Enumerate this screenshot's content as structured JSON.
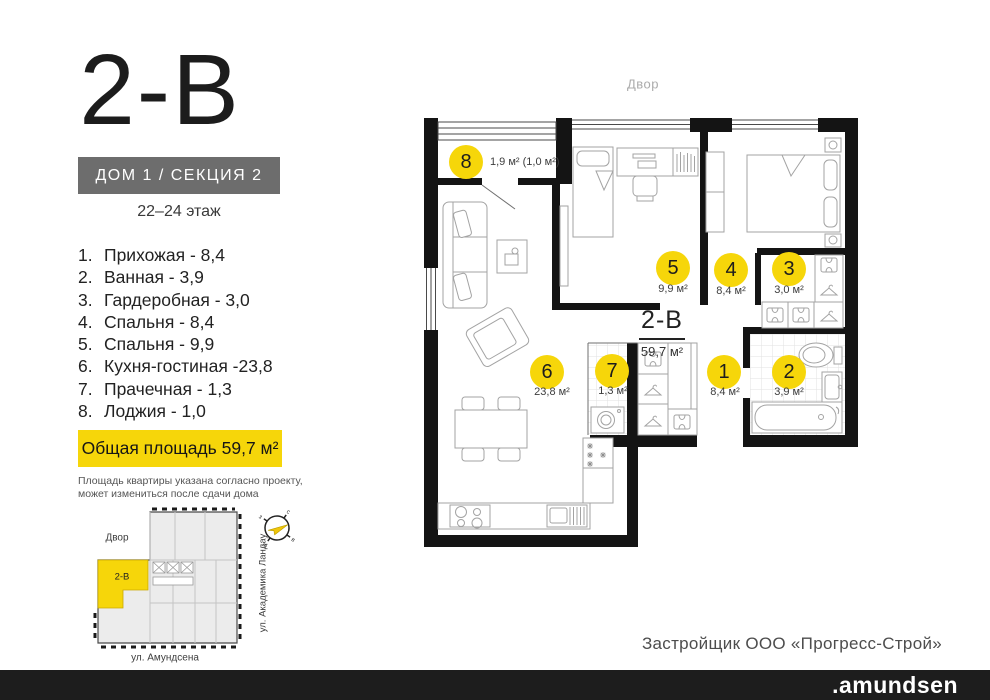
{
  "header": {
    "plan_code": "2-В",
    "section_label": "ДОМ 1 / СЕКЦИЯ 2",
    "floors_label": "22–24 этаж"
  },
  "room_list": [
    {
      "num": "1.",
      "name": "Прихожая",
      "area": "8,4",
      "display": "Прихожая - 8,4"
    },
    {
      "num": "2.",
      "name": "Ванная",
      "area": "3,9",
      "display": "Ванная - 3,9"
    },
    {
      "num": "3.",
      "name": "Гардеробная",
      "area": "3,0",
      "display": "Гардеробная - 3,0"
    },
    {
      "num": "4.",
      "name": "Спальня",
      "area": "8,4",
      "display": "Спальня - 8,4"
    },
    {
      "num": "5.",
      "name": "Спальня",
      "area": "9,9",
      "display": "Спальня - 9,9"
    },
    {
      "num": "6.",
      "name": "Кухня-гостиная",
      "area": "23,8",
      "display": "Кухня-гостиная -23,8"
    },
    {
      "num": "7.",
      "name": "Прачечная",
      "area": "1,3",
      "display": "Прачечная - 1,3"
    },
    {
      "num": "8.",
      "name": "Лоджия",
      "area": "1,0",
      "display": "Лоджия - 1,0"
    }
  ],
  "total_area_label": "Общая площадь 59,7 м²",
  "disclaimer": [
    "Площадь квартиры указана согласно проекту,",
    "может измениться после сдачи дома"
  ],
  "floor_plan": {
    "yard_label": "Двор",
    "unit_code": "2-В",
    "unit_area": "59,7 м²",
    "markers": [
      {
        "num": "8",
        "area": "1,9 м² (1,0 м²)"
      },
      {
        "num": "5",
        "area": "9,9 м²"
      },
      {
        "num": "4",
        "area": "8,4 м²"
      },
      {
        "num": "3",
        "area": "3,0 м²"
      },
      {
        "num": "6",
        "area": "23,8 м²"
      },
      {
        "num": "7",
        "area": "1,3 м²"
      },
      {
        "num": "1",
        "area": "8,4 м²"
      },
      {
        "num": "2",
        "area": "3,9 м²"
      }
    ]
  },
  "site_plan": {
    "yard_label": "Двор",
    "unit_label": "2-В",
    "street_bottom": "ул. Амундсена",
    "street_right": "ул. Академика Ландау",
    "compass": {
      "n": "с",
      "e": "в",
      "s": "ю",
      "w": "з"
    }
  },
  "developer_label": "Застройщик ООО «Прогресс-Строй»",
  "footer_logo": ".amundsen",
  "colors": {
    "accent_yellow": "#F6D60A",
    "wall_black": "#141414",
    "badge_gray": "#6D6D6D",
    "footer_black": "#1D1D1D"
  }
}
